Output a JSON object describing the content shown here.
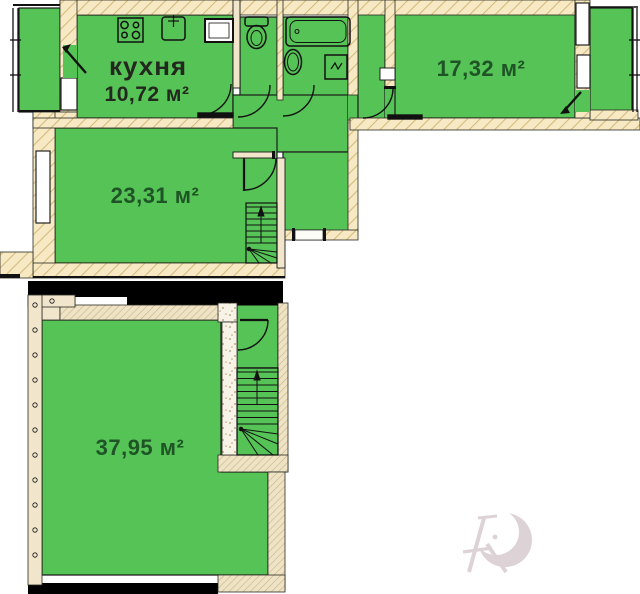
{
  "title": "apartment-floor-plan",
  "labels": {
    "kitchen_name": "кухня",
    "kitchen_area": "10,72 м²",
    "room_right_area": "17,32 м²",
    "room_middle_area": "23,31 м²",
    "room_lower_area": "37,95 м²"
  },
  "colors": {
    "room_fill": "#55c355",
    "wall_fill": "#f6e9c3",
    "wall_hatch_line": "#d2b87b",
    "lower_wall_fill": "#eee3c4",
    "outline": "#111111",
    "structural_black": "#000000",
    "area_text_green": "#1f5426",
    "kitchen_text_dark": "#23281f",
    "watermark": "#d8ccd1"
  },
  "icons": [
    "stove-icon",
    "kitchen-sink-icon",
    "appliance-box-icon",
    "toilet-icon",
    "bathtub-icon",
    "washbasin-icon",
    "washing-machine-icon",
    "stairs-up-icon",
    "stairs-down-icon",
    "door-arc-icon",
    "window-icon",
    "balcony-glazing-icon",
    "watermark-logo"
  ]
}
